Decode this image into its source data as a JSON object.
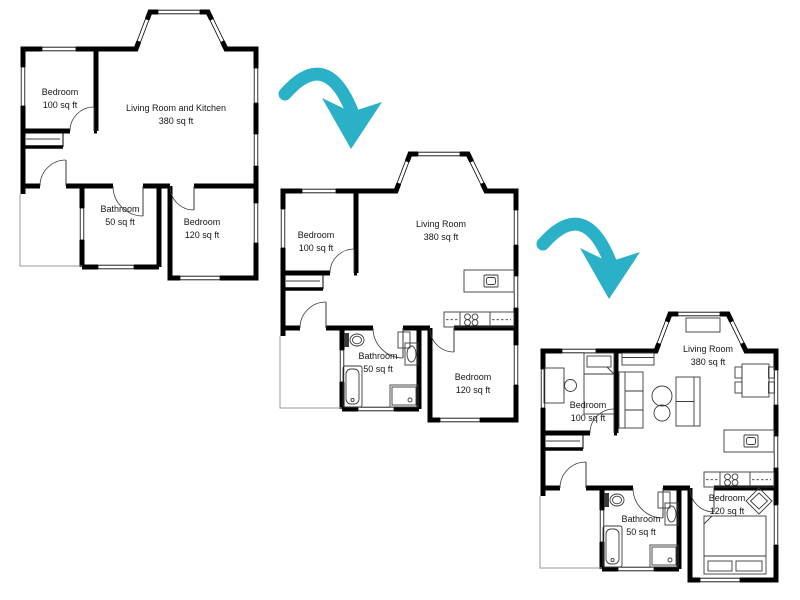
{
  "figure": {
    "kind": "floor-plan-remodel-progression",
    "stage_count": 3,
    "background": "#ffffff"
  },
  "colors": {
    "arrow": "#2ab1c7",
    "walls": "#000000",
    "text": "#151515",
    "furniture": "#3a3a3a",
    "deck": "#9a9a9a"
  },
  "plans": [
    {
      "stage": 1,
      "rooms": [
        {
          "name": "Bedroom",
          "area": "100 sq ft"
        },
        {
          "name": "Living Room and Kitchen",
          "area": "380 sq ft"
        },
        {
          "name": "Bathroom",
          "area": "50 sq ft"
        },
        {
          "name": "Bedroom",
          "area": "120 sq ft"
        }
      ],
      "furnishings": []
    },
    {
      "stage": 2,
      "rooms": [
        {
          "name": "Bedroom",
          "area": "100 sq ft"
        },
        {
          "name": "Living Room",
          "area": "380 sq ft"
        },
        {
          "name": "Bathroom",
          "area": "50 sq ft"
        },
        {
          "name": "Bedroom",
          "area": "120 sq ft"
        }
      ],
      "furnishings": [
        "kitchen-island-with-sink",
        "kitchen-counter-with-stovetop",
        "toilet",
        "bathroom-sink",
        "bathtub",
        "shower",
        "bathroom-shelf"
      ]
    },
    {
      "stage": 3,
      "rooms": [
        {
          "name": "Bedroom",
          "area": "100 sq ft"
        },
        {
          "name": "Living Room",
          "area": "380 sq ft"
        },
        {
          "name": "Bathroom",
          "area": "50 sq ft"
        },
        {
          "name": "Bedroom",
          "area": "120 sq ft"
        }
      ],
      "furnishings": [
        "kitchen-island-with-sink",
        "kitchen-counter-with-stovetop",
        "toilet",
        "bathroom-sink",
        "bathtub",
        "shower",
        "bathroom-shelf",
        "single-bed",
        "desk-with-chair",
        "media-cabinet",
        "bay-window-seat",
        "sofa",
        "round-coffee-tables",
        "armchair",
        "dining-table-with-chairs",
        "accent-chair",
        "double-bed"
      ]
    }
  ],
  "arrows": [
    {
      "name": "arrow-stage-1-to-2"
    },
    {
      "name": "arrow-stage-2-to-3"
    }
  ]
}
